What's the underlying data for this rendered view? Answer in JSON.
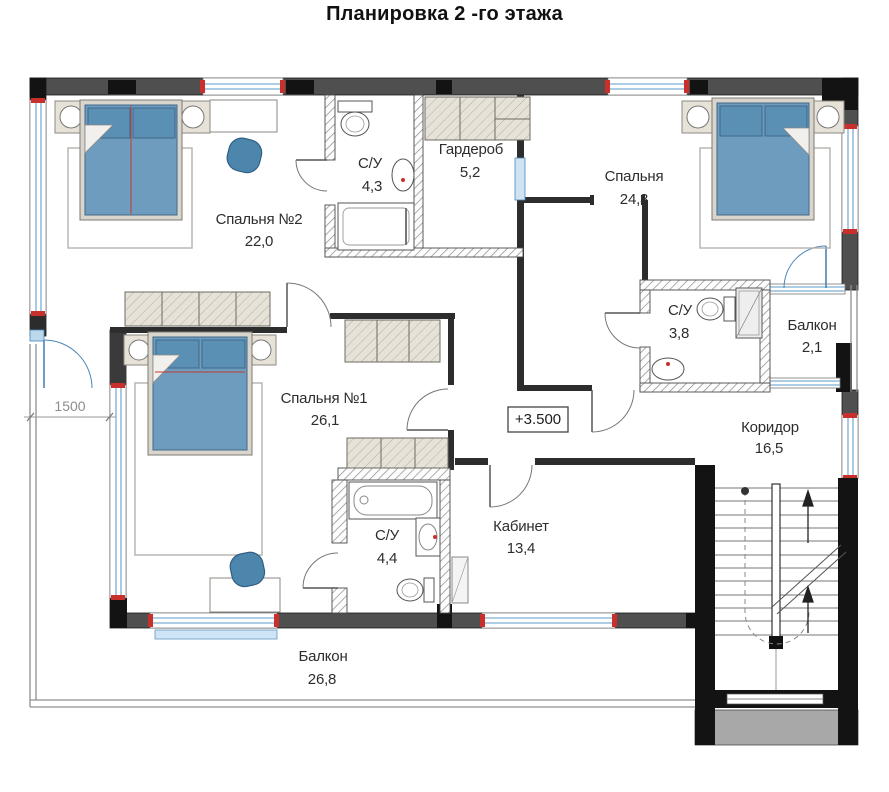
{
  "title": "Планировка 2 -го этажа",
  "rooms": {
    "bedroom2": {
      "name": "Спальня №2",
      "area": "22,0"
    },
    "bath_top": {
      "name": "С/У",
      "area": "4,3"
    },
    "wardrobe": {
      "name": "Гардероб",
      "area": "5,2"
    },
    "bedroom_master": {
      "name": "Спальня",
      "area": "24,3"
    },
    "bath_right": {
      "name": "С/У",
      "area": "3,8"
    },
    "balcony_right": {
      "name": "Балкон",
      "area": "2,1"
    },
    "bedroom1": {
      "name": "Спальня №1",
      "area": "26,1"
    },
    "corridor": {
      "name": "Коридор",
      "area": "16,5"
    },
    "study": {
      "name": "Кабинет",
      "area": "13,4"
    },
    "bath_bottom": {
      "name": "С/У",
      "area": "4,4"
    },
    "balcony_bottom": {
      "name": "Балкон",
      "area": "26,8"
    }
  },
  "annotations": {
    "elevation": "+3.500",
    "dimension_left": "1500"
  },
  "colors": {
    "wall_gray": "#4f4f4f",
    "wall_black": "#131313",
    "window_blue": "#7aafd4",
    "window_marker_red": "#c9302c",
    "bed_blue": "#6d9cbe",
    "chair_blue": "#4d86ad",
    "furniture_beige": "#e6e2d8"
  }
}
